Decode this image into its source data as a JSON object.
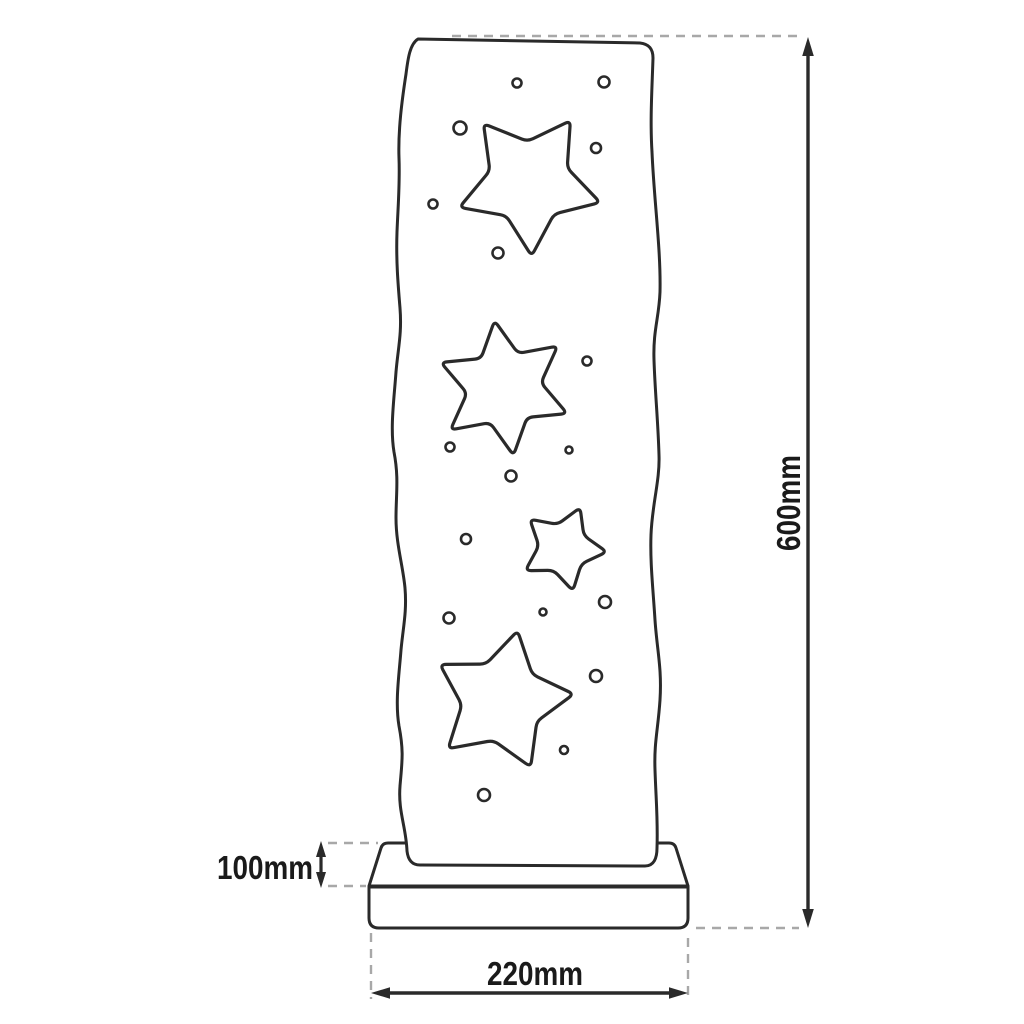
{
  "dimensions": {
    "height_label": "600mm",
    "width_label": "220mm",
    "base_height_label": "100mm"
  },
  "colors": {
    "line": "#2a2a2a",
    "dash": "#a8a8a8",
    "text": "#1a1a1a",
    "background": "#ffffff"
  },
  "drawing": {
    "stars": [
      {
        "name": "star-cutout-top-large",
        "cx": 529,
        "cy": 182,
        "points": 5,
        "outer_r": 74,
        "inner_ratio": 0.55,
        "rotation_deg": -38
      },
      {
        "name": "star-cutout-six-point",
        "cx": 504,
        "cy": 388,
        "points": 6,
        "outer_r": 68,
        "inner_ratio": 0.55,
        "rotation_deg": -8
      },
      {
        "name": "star-cutout-small",
        "cx": 563,
        "cy": 548,
        "points": 5,
        "outer_r": 44,
        "inner_ratio": 0.55,
        "rotation_deg": 23
      },
      {
        "name": "star-cutout-bottom-large",
        "cx": 502,
        "cy": 701,
        "points": 5,
        "outer_r": 72,
        "inner_ratio": 0.56,
        "rotation_deg": 12.5
      }
    ],
    "holes": [
      {
        "cx": 517,
        "cy": 83,
        "r": 4.5
      },
      {
        "cx": 604,
        "cy": 82,
        "r": 5.5
      },
      {
        "cx": 460,
        "cy": 128,
        "r": 6.5
      },
      {
        "cx": 596,
        "cy": 148,
        "r": 5
      },
      {
        "cx": 433,
        "cy": 204,
        "r": 4.5
      },
      {
        "cx": 498,
        "cy": 253,
        "r": 5.5
      },
      {
        "cx": 587,
        "cy": 361,
        "r": 4.5
      },
      {
        "cx": 450,
        "cy": 447,
        "r": 4.5
      },
      {
        "cx": 569,
        "cy": 450,
        "r": 3.5
      },
      {
        "cx": 511,
        "cy": 476,
        "r": 5.5
      },
      {
        "cx": 466,
        "cy": 539,
        "r": 5
      },
      {
        "cx": 605,
        "cy": 602,
        "r": 6
      },
      {
        "cx": 543,
        "cy": 612,
        "r": 3.5
      },
      {
        "cx": 449,
        "cy": 618,
        "r": 5.5
      },
      {
        "cx": 596,
        "cy": 676,
        "r": 6
      },
      {
        "cx": 564,
        "cy": 750,
        "r": 4
      },
      {
        "cx": 484,
        "cy": 795,
        "r": 6
      }
    ]
  }
}
